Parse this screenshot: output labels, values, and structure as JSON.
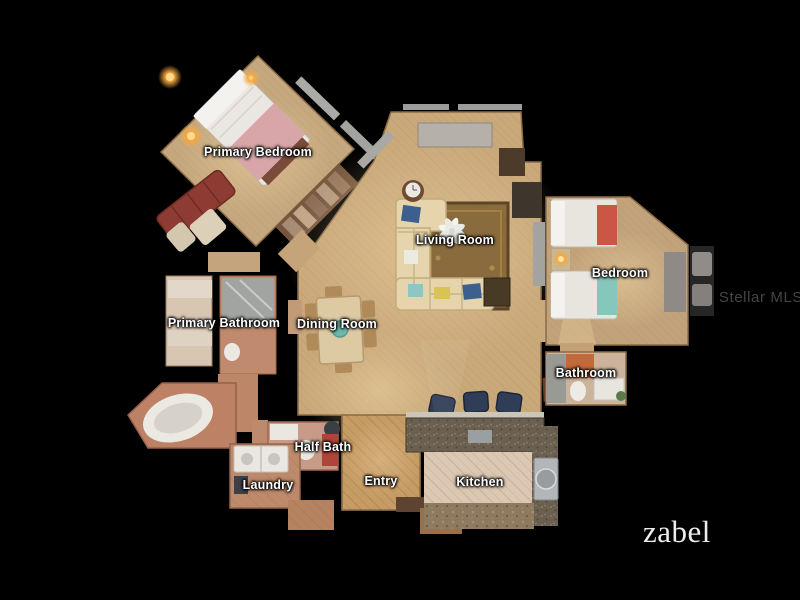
{
  "scene": {
    "background_color": "#000000",
    "label_text_color": "#ffffff",
    "floor_tan_color": "#c9a87a",
    "tile_terracotta_color": "#bd8a6c",
    "tile_light_color": "#dbc7b2"
  },
  "watermark": {
    "text": "Stellar MLS",
    "color": "#454545"
  },
  "brand_logo": {
    "text": "zabel",
    "color": "#ededed"
  },
  "floorplan": {
    "rooms": [
      {
        "id": "primary-bedroom",
        "label": "Primary Bedroom",
        "x": 258,
        "y": 152
      },
      {
        "id": "living-room",
        "label": "Living Room",
        "x": 455,
        "y": 240
      },
      {
        "id": "bedroom",
        "label": "Bedroom",
        "x": 620,
        "y": 273
      },
      {
        "id": "primary-bathroom",
        "label": "Primary Bathroom",
        "x": 224,
        "y": 323
      },
      {
        "id": "dining-room",
        "label": "Dining Room",
        "x": 337,
        "y": 324
      },
      {
        "id": "bathroom",
        "label": "Bathroom",
        "x": 586,
        "y": 373
      },
      {
        "id": "half-bath",
        "label": "Half Bath",
        "x": 323,
        "y": 447
      },
      {
        "id": "laundry",
        "label": "Laundry",
        "x": 268,
        "y": 485
      },
      {
        "id": "entry",
        "label": "Entry",
        "x": 381,
        "y": 481
      },
      {
        "id": "kitchen",
        "label": "Kitchen",
        "x": 480,
        "y": 482
      }
    ]
  }
}
